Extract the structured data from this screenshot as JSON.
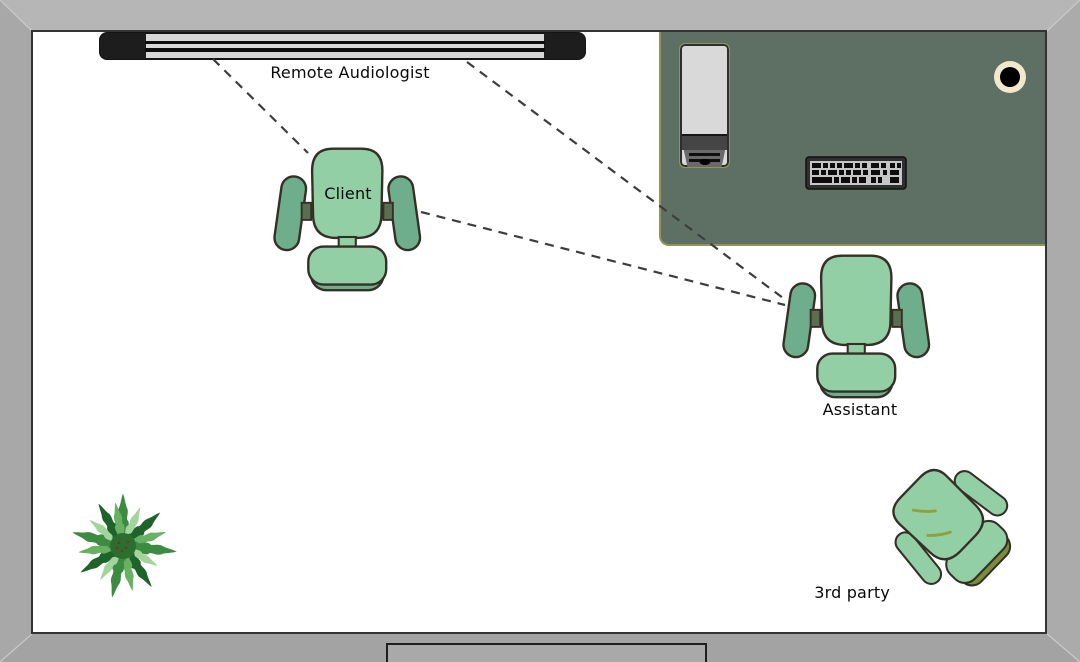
{
  "scene": {
    "type": "teleaudiology-room-floor-plan",
    "labels": {
      "remote_audiologist": "Remote Audiologist",
      "client": "Client",
      "assistant": "Assistant",
      "third_party": "3rd party"
    },
    "objects": [
      {
        "name": "wall-screen",
        "label": "Remote Audiologist"
      },
      {
        "name": "desk"
      },
      {
        "name": "monitor"
      },
      {
        "name": "keyboard"
      },
      {
        "name": "mug"
      },
      {
        "name": "client-chair",
        "label": "Client"
      },
      {
        "name": "assistant-chair",
        "label": "Assistant"
      },
      {
        "name": "third-party-chair",
        "label": "3rd party"
      },
      {
        "name": "plant"
      },
      {
        "name": "door-table"
      }
    ],
    "connections": [
      {
        "from": "Remote Audiologist",
        "to": "Client",
        "style": "dashed"
      },
      {
        "from": "Remote Audiologist",
        "to": "Assistant",
        "style": "dashed"
      },
      {
        "from": "Client",
        "to": "Assistant",
        "style": "dashed"
      }
    ],
    "colors": {
      "background": "#aaaaaa",
      "room": "#ffffff",
      "desk": "#5e7064",
      "chair_light": "#92cfa5",
      "chair_dark": "#6fae8c",
      "chair_outline": "#352f25",
      "olive_accent": "#7b8c3f",
      "dash_line": "#3d3d3d",
      "tv_silver": "#d8d8d8",
      "tv_black": "#1d1d1d",
      "mug_ring": "#f2e9cd"
    }
  }
}
